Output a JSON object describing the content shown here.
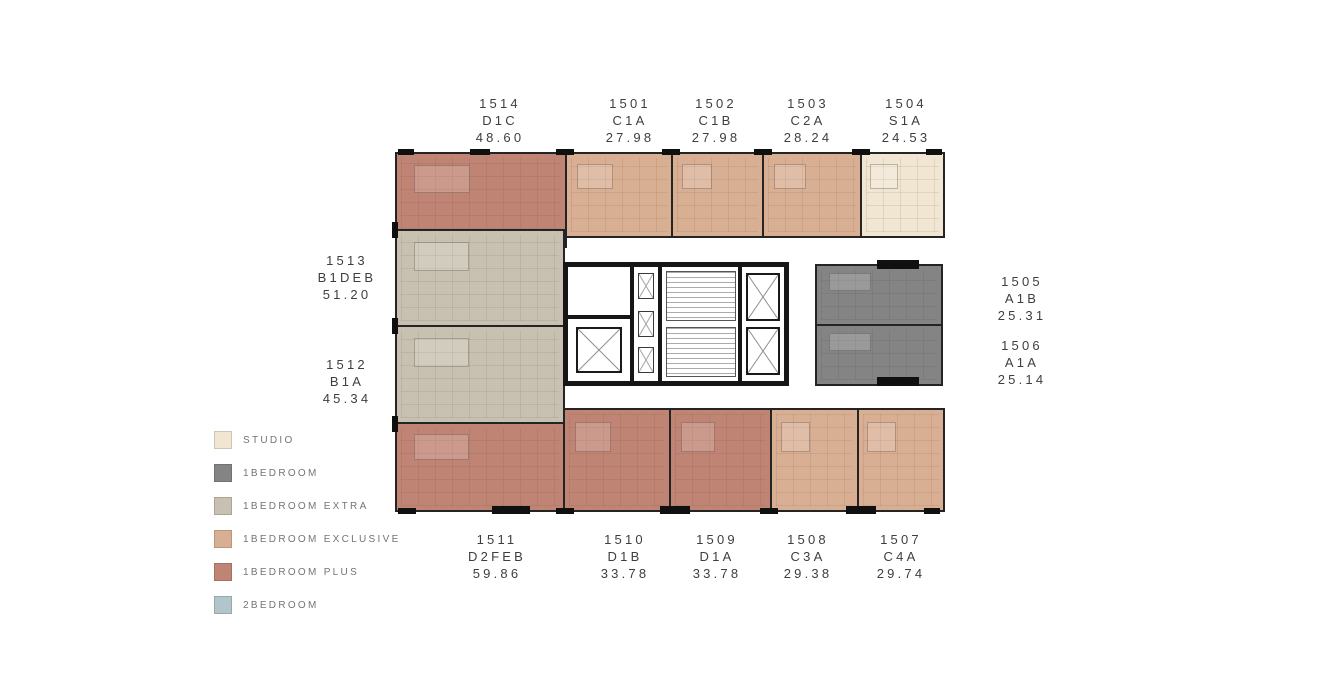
{
  "colors": {
    "studio": "#f1e6d1",
    "one_bedroom": "#848484",
    "one_bedroom_extra": "#c8c1b1",
    "one_bedroom_exclusive": "#d9af93",
    "one_bedroom_plus": "#c08474",
    "two_bedroom": "#b1c5ca",
    "wall": "#161616",
    "label_text": "#3e3e3e"
  },
  "legend": {
    "items": [
      {
        "label": "STUDIO",
        "color": "studio"
      },
      {
        "label": "1BEDROOM",
        "color": "one_bedroom"
      },
      {
        "label": "1BEDROOM EXTRA",
        "color": "one_bedroom_extra"
      },
      {
        "label": "1BEDROOM EXCLUSIVE",
        "color": "one_bedroom_exclusive"
      },
      {
        "label": "1BEDROOM PLUS",
        "color": "one_bedroom_plus"
      },
      {
        "label": "2BEDROOM",
        "color": "two_bedroom"
      }
    ]
  },
  "units": [
    {
      "id": "1514",
      "code": "D1C",
      "area": "48.60",
      "type": "one_bedroom_plus"
    },
    {
      "id": "1501",
      "code": "C1A",
      "area": "27.98",
      "type": "one_bedroom_exclusive"
    },
    {
      "id": "1502",
      "code": "C1B",
      "area": "27.98",
      "type": "one_bedroom_exclusive"
    },
    {
      "id": "1503",
      "code": "C2A",
      "area": "28.24",
      "type": "one_bedroom_exclusive"
    },
    {
      "id": "1504",
      "code": "S1A",
      "area": "24.53",
      "type": "studio"
    },
    {
      "id": "1505",
      "code": "A1B",
      "area": "25.31",
      "type": "one_bedroom"
    },
    {
      "id": "1506",
      "code": "A1A",
      "area": "25.14",
      "type": "one_bedroom"
    },
    {
      "id": "1507",
      "code": "C4A",
      "area": "29.74",
      "type": "one_bedroom_exclusive"
    },
    {
      "id": "1508",
      "code": "C3A",
      "area": "29.38",
      "type": "one_bedroom_exclusive"
    },
    {
      "id": "1509",
      "code": "D1A",
      "area": "33.78",
      "type": "one_bedroom_plus"
    },
    {
      "id": "1510",
      "code": "D1B",
      "area": "33.78",
      "type": "one_bedroom_plus"
    },
    {
      "id": "1511",
      "code": "D2FEB",
      "area": "59.86",
      "type": "one_bedroom_plus"
    },
    {
      "id": "1512",
      "code": "B1A",
      "area": "45.34",
      "type": "one_bedroom_extra"
    },
    {
      "id": "1513",
      "code": "B1DEB",
      "area": "51.20",
      "type": "one_bedroom_extra"
    }
  ]
}
